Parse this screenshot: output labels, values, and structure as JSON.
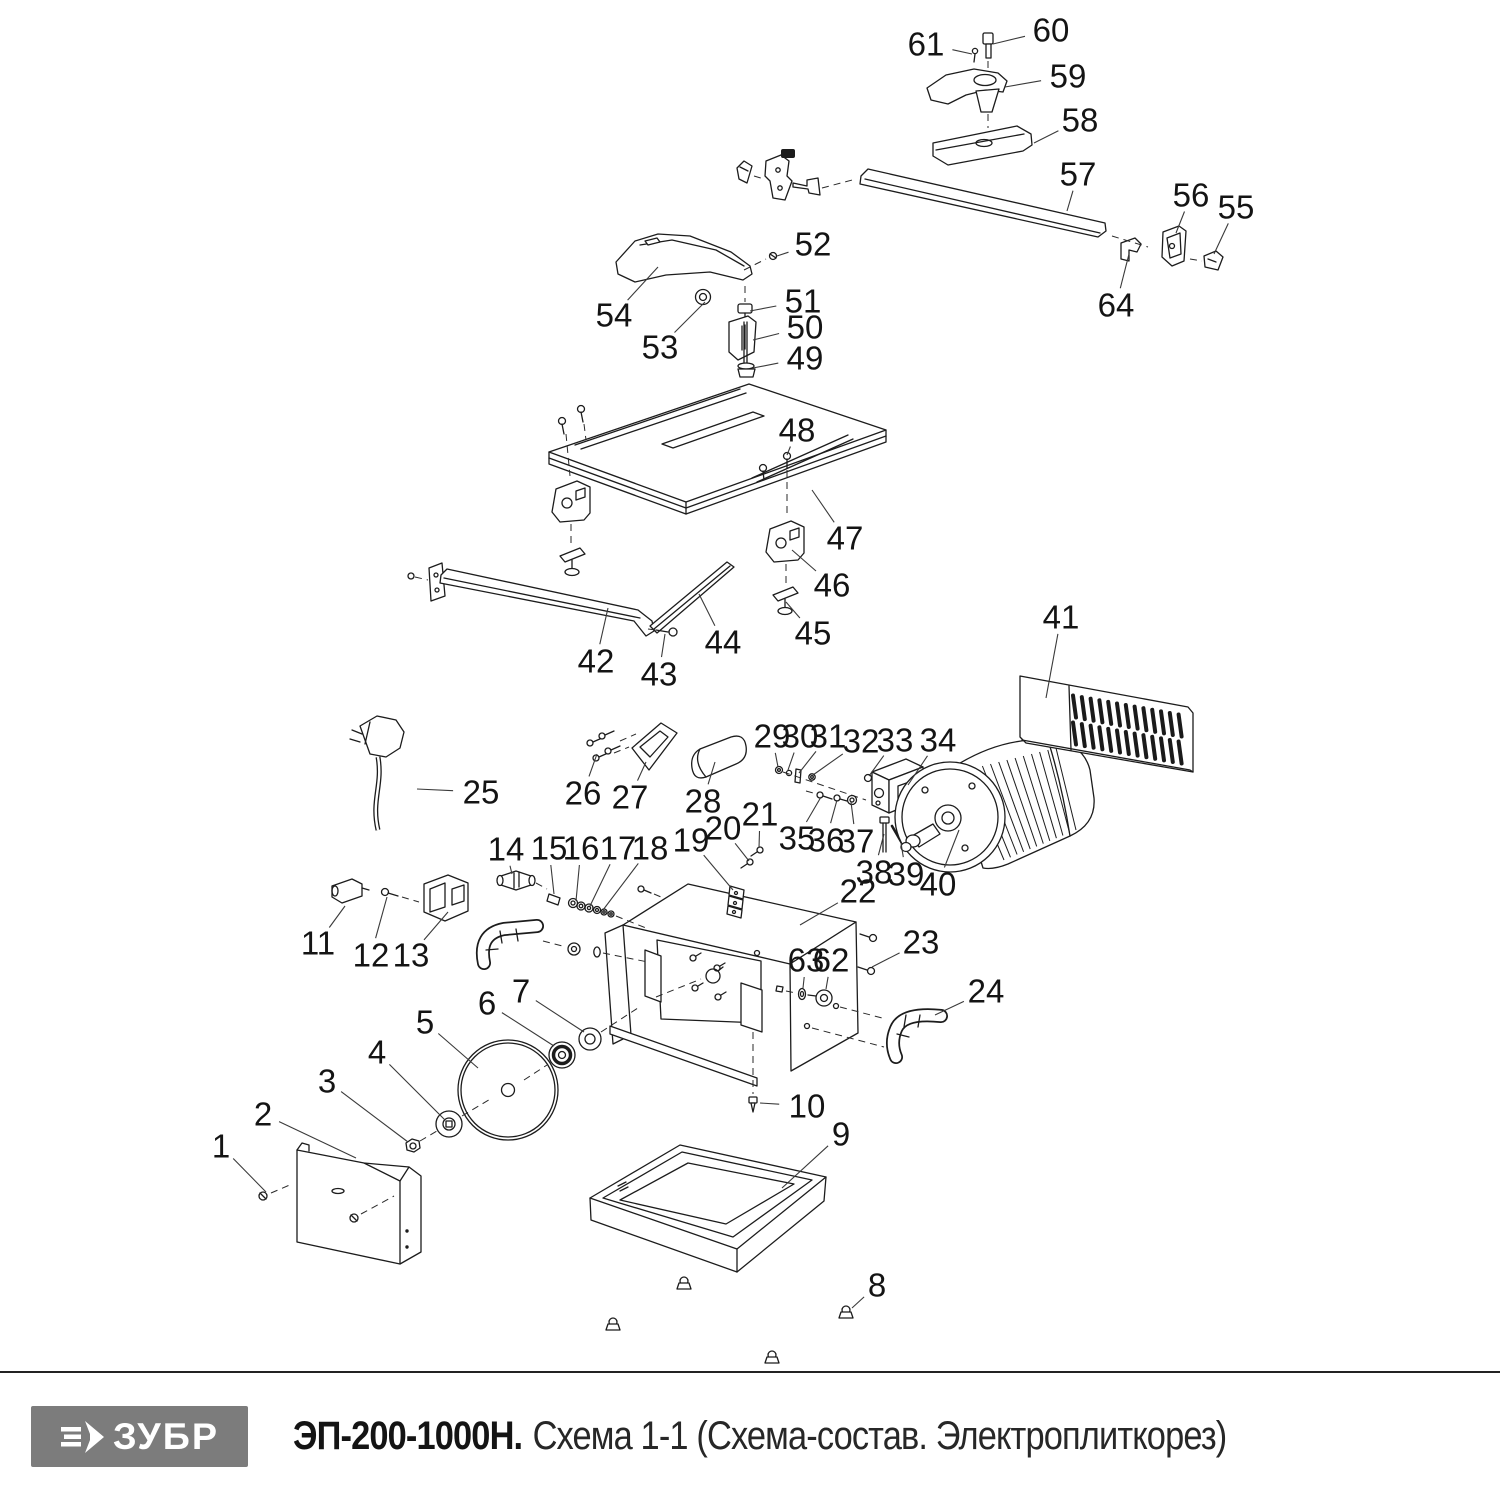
{
  "footer": {
    "brand": "ЗУБР",
    "model": "ЭП-200-1000Н.",
    "subtitle": "Схема 1-1 (Схема-состав. Электроплиткорез)"
  },
  "colors": {
    "logo_bg": "#7c7c7c",
    "line": "#1c1c1c"
  },
  "diagram": {
    "kind": "exploded-parts-diagram",
    "callouts": [
      {
        "n": "1",
        "x": 221,
        "y": 1146,
        "tx": 266,
        "ty": 1192
      },
      {
        "n": "2",
        "x": 263,
        "y": 1114,
        "tx": 356,
        "ty": 1158
      },
      {
        "n": "3",
        "x": 327,
        "y": 1081,
        "tx": 408,
        "ty": 1142
      },
      {
        "n": "4",
        "x": 377,
        "y": 1052,
        "tx": 445,
        "ty": 1120
      },
      {
        "n": "5",
        "x": 425,
        "y": 1022,
        "tx": 478,
        "ty": 1068
      },
      {
        "n": "6",
        "x": 487,
        "y": 1003,
        "tx": 554,
        "ty": 1046
      },
      {
        "n": "7",
        "x": 521,
        "y": 991,
        "tx": 584,
        "ty": 1032
      },
      {
        "n": "8",
        "x": 877,
        "y": 1285,
        "tx": 852,
        "ty": 1308
      },
      {
        "n": "9",
        "x": 841,
        "y": 1134,
        "tx": 782,
        "ty": 1188
      },
      {
        "n": "10",
        "x": 807,
        "y": 1106,
        "tx": 760,
        "ty": 1103
      },
      {
        "n": "11",
        "x": 318,
        "y": 943,
        "tx": 345,
        "ty": 906
      },
      {
        "n": "12",
        "x": 371,
        "y": 955,
        "tx": 387,
        "ty": 897
      },
      {
        "n": "13",
        "x": 411,
        "y": 955,
        "tx": 448,
        "ty": 912
      },
      {
        "n": "14",
        "x": 506,
        "y": 849,
        "tx": 512,
        "ty": 874
      },
      {
        "n": "15",
        "x": 549,
        "y": 848,
        "tx": 554,
        "ty": 894
      },
      {
        "n": "16",
        "x": 581,
        "y": 848,
        "tx": 576,
        "ty": 901
      },
      {
        "n": "17",
        "x": 618,
        "y": 848,
        "tx": 590,
        "ty": 906
      },
      {
        "n": "18",
        "x": 650,
        "y": 848,
        "tx": 603,
        "ty": 910
      },
      {
        "n": "19",
        "x": 691,
        "y": 840,
        "tx": 733,
        "ty": 890
      },
      {
        "n": "20",
        "x": 723,
        "y": 828,
        "tx": 749,
        "ty": 861
      },
      {
        "n": "21",
        "x": 760,
        "y": 814,
        "tx": 759,
        "ty": 848
      },
      {
        "n": "22",
        "x": 858,
        "y": 891,
        "tx": 800,
        "ty": 925
      },
      {
        "n": "23",
        "x": 921,
        "y": 942,
        "tx": 872,
        "ty": 967
      },
      {
        "n": "24",
        "x": 986,
        "y": 991,
        "tx": 935,
        "ty": 1015
      },
      {
        "n": "25",
        "x": 481,
        "y": 792,
        "tx": 417,
        "ty": 789
      },
      {
        "n": "26",
        "x": 583,
        "y": 793,
        "tx": 597,
        "ty": 754
      },
      {
        "n": "27",
        "x": 630,
        "y": 797,
        "tx": 646,
        "ty": 762
      },
      {
        "n": "28",
        "x": 703,
        "y": 801,
        "tx": 715,
        "ty": 762
      },
      {
        "n": "29",
        "x": 772,
        "y": 736,
        "tx": 778,
        "ty": 767
      },
      {
        "n": "30",
        "x": 800,
        "y": 736,
        "tx": 788,
        "ty": 770
      },
      {
        "n": "31",
        "x": 828,
        "y": 736,
        "tx": 799,
        "ty": 773
      },
      {
        "n": "32",
        "x": 861,
        "y": 741,
        "tx": 813,
        "ty": 775
      },
      {
        "n": "33",
        "x": 895,
        "y": 740,
        "tx": 869,
        "ty": 776
      },
      {
        "n": "34",
        "x": 938,
        "y": 740,
        "tx": 908,
        "ty": 785
      },
      {
        "n": "35",
        "x": 797,
        "y": 838,
        "tx": 821,
        "ty": 797
      },
      {
        "n": "36",
        "x": 826,
        "y": 840,
        "tx": 837,
        "ty": 800
      },
      {
        "n": "37",
        "x": 856,
        "y": 841,
        "tx": 851,
        "ty": 802
      },
      {
        "n": "38",
        "x": 874,
        "y": 872,
        "tx": 884,
        "ty": 834
      },
      {
        "n": "39",
        "x": 906,
        "y": 874,
        "tx": 901,
        "ty": 843
      },
      {
        "n": "40",
        "x": 938,
        "y": 884,
        "tx": 959,
        "ty": 830
      },
      {
        "n": "41",
        "x": 1061,
        "y": 617,
        "tx": 1046,
        "ty": 698
      },
      {
        "n": "42",
        "x": 596,
        "y": 661,
        "tx": 608,
        "ty": 608
      },
      {
        "n": "43",
        "x": 659,
        "y": 674,
        "tx": 665,
        "ty": 634
      },
      {
        "n": "44",
        "x": 723,
        "y": 642,
        "tx": 699,
        "ty": 594
      },
      {
        "n": "45",
        "x": 813,
        "y": 633,
        "tx": 786,
        "ty": 602
      },
      {
        "n": "46",
        "x": 832,
        "y": 585,
        "tx": 792,
        "ty": 550
      },
      {
        "n": "47",
        "x": 845,
        "y": 538,
        "tx": 812,
        "ty": 490
      },
      {
        "n": "48",
        "x": 797,
        "y": 430,
        "tx": 787,
        "ty": 455
      },
      {
        "n": "49",
        "x": 805,
        "y": 358,
        "tx": 753,
        "ty": 368
      },
      {
        "n": "50",
        "x": 805,
        "y": 327,
        "tx": 753,
        "ty": 340
      },
      {
        "n": "51",
        "x": 803,
        "y": 301,
        "tx": 750,
        "ty": 311
      },
      {
        "n": "52",
        "x": 813,
        "y": 244,
        "tx": 777,
        "ty": 256
      },
      {
        "n": "53",
        "x": 660,
        "y": 347,
        "tx": 705,
        "ty": 302
      },
      {
        "n": "54",
        "x": 614,
        "y": 315,
        "tx": 658,
        "ty": 267
      },
      {
        "n": "55",
        "x": 1236,
        "y": 207,
        "tx": 1214,
        "ty": 254
      },
      {
        "n": "56",
        "x": 1191,
        "y": 195,
        "tx": 1176,
        "ty": 233
      },
      {
        "n": "57",
        "x": 1078,
        "y": 174,
        "tx": 1067,
        "ty": 211
      },
      {
        "n": "58",
        "x": 1080,
        "y": 120,
        "tx": 1034,
        "ty": 143
      },
      {
        "n": "59",
        "x": 1068,
        "y": 76,
        "tx": 1005,
        "ty": 87
      },
      {
        "n": "60",
        "x": 1051,
        "y": 30,
        "tx": 993,
        "ty": 44
      },
      {
        "n": "61",
        "x": 926,
        "y": 44,
        "tx": 972,
        "ty": 54
      },
      {
        "n": "62",
        "x": 831,
        "y": 960,
        "tx": 826,
        "ty": 989
      },
      {
        "n": "63",
        "x": 806,
        "y": 960,
        "tx": 803,
        "ty": 988
      },
      {
        "n": "64",
        "x": 1116,
        "y": 305,
        "tx": 1129,
        "ty": 254
      }
    ]
  }
}
